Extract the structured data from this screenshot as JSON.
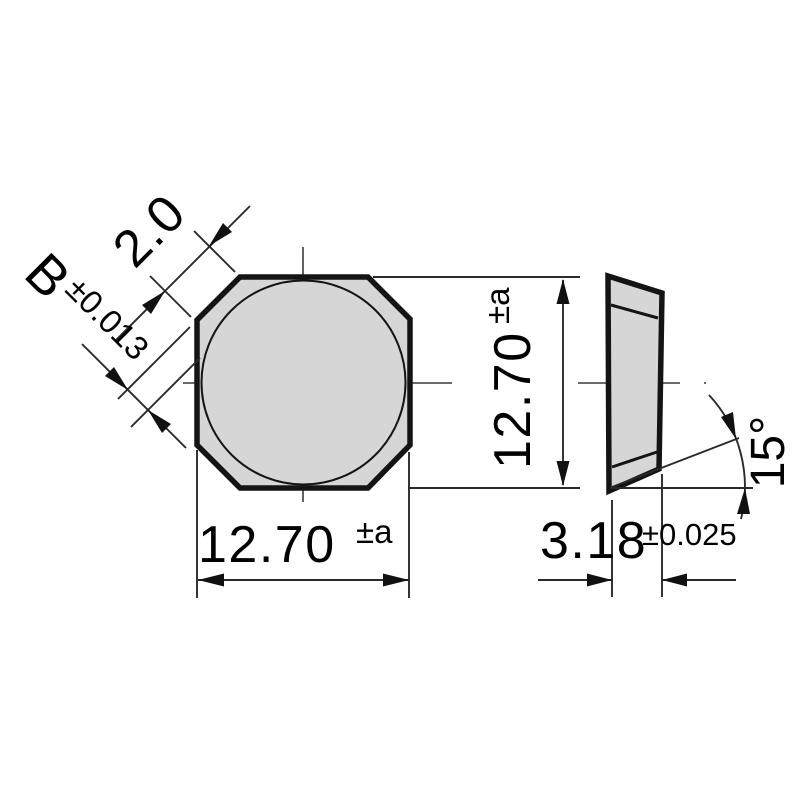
{
  "figure": {
    "front_view": {
      "chamfer_length": "2.0",
      "corner_dim_letter": "B",
      "corner_dim_tolerance": "±0.013",
      "height_value": "12.70",
      "height_tolerance": "±a",
      "width_value": "12.70",
      "width_tolerance": "±a"
    },
    "side_view": {
      "thickness_value": "3.18",
      "thickness_tolerance": "±0.025",
      "clearance_angle": "15°"
    },
    "colors": {
      "insert_fill": "#d6d6d6",
      "outline": "#141414",
      "dimension_lines": "#2a2a2a"
    }
  }
}
